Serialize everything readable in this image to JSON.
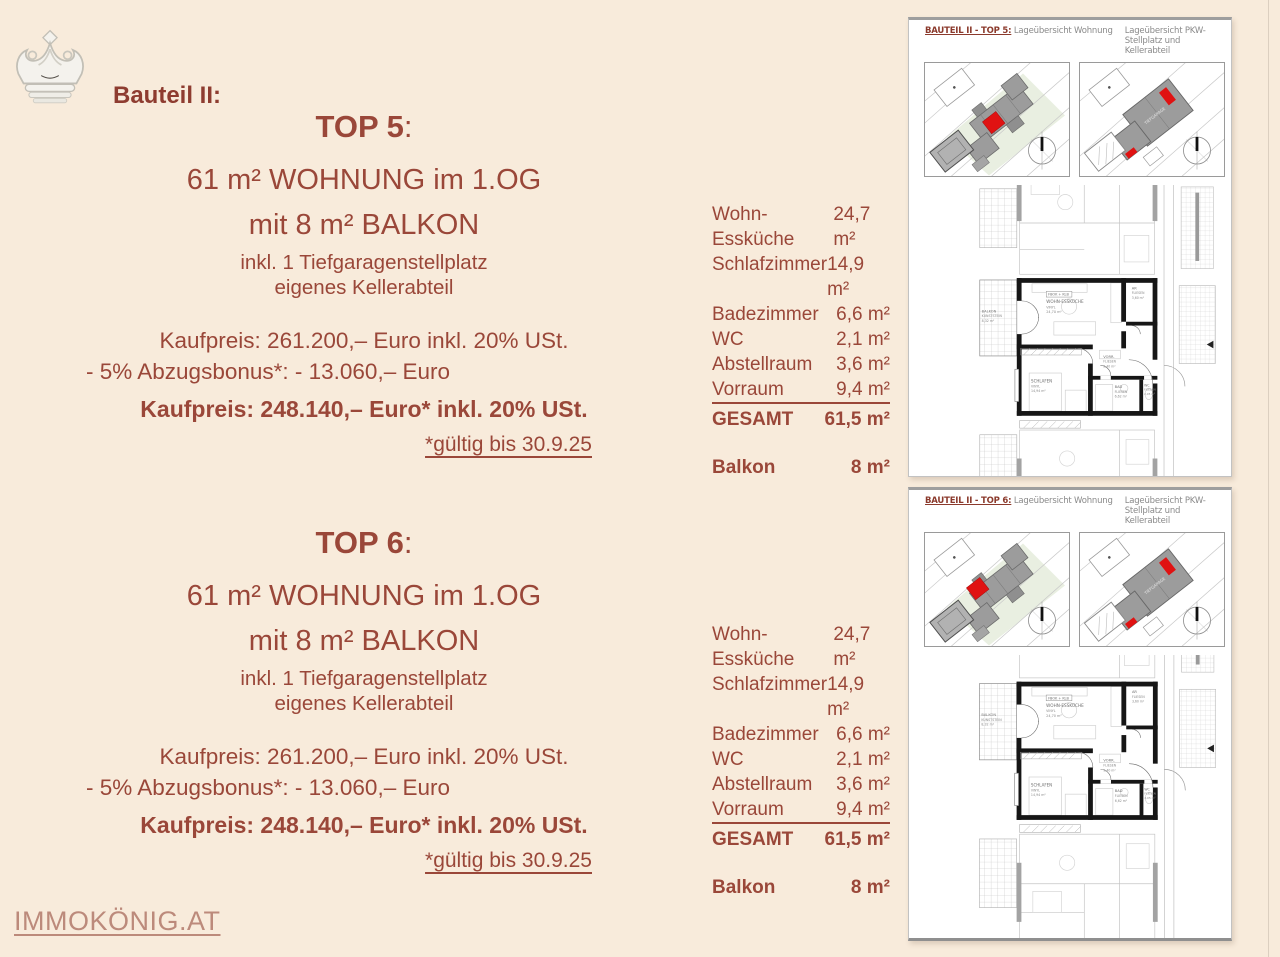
{
  "page": {
    "background": "#f8ebdb",
    "accent": "#9a4739",
    "accent_dark": "#8e3c30",
    "link_color": "#bc8a7b",
    "highlight_red": "#e01212",
    "building_gray": "#9c9c9c"
  },
  "brand": {
    "label": "Bauteil II:",
    "logo_icon": "crown-icon",
    "footer_link": "IMMOKÖNIG.AT"
  },
  "listings": [
    {
      "title": "TOP 5",
      "colon": ":",
      "subtitle1": "61 m² WOHNUNG im 1.OG",
      "subtitle2": "mit 8 m² BALKON",
      "detail1": "inkl. 1 Tiefgaragenstellplatz",
      "detail2": "eigenes Kellerabteil",
      "price_original": "Kaufpreis: 261.200,– Euro inkl. 20% USt.",
      "price_discount": "- 5% Abzugsbonus*: - 13.060,– Euro",
      "price_final": "Kaufpreis: 248.140,– Euro* inkl. 20% USt.",
      "validity": "*gültig bis 30.9.25",
      "rooms": [
        {
          "label": "Wohn-Essküche",
          "area": "24,7 m²"
        },
        {
          "label": "Schlafzimmer",
          "area": "14,9 m²"
        },
        {
          "label": "Badezimmer",
          "area": "6,6 m²"
        },
        {
          "label": "WC",
          "area": "2,1 m²"
        },
        {
          "label": "Abstellraum",
          "area": "3,6 m²"
        },
        {
          "label": "Vorraum",
          "area": "9,4 m²"
        }
      ],
      "total_label": "GESAMT",
      "total_area": "61,5 m²",
      "balcony_label": "Balkon",
      "balcony_area": "8 m²",
      "plan": {
        "header_bold": "BAUTEIL II - TOP 5:",
        "header_left": "Lageübersicht Wohnung",
        "header_right": "Lageübersicht PKW-Stellplatz und Kellerabteil"
      }
    },
    {
      "title": "TOP 6",
      "colon": ":",
      "subtitle1": "61 m² WOHNUNG im 1.OG",
      "subtitle2": "mit 8 m² BALKON",
      "detail1": "inkl. 1 Tiefgaragenstellplatz",
      "detail2": "eigenes Kellerabteil",
      "price_original": "Kaufpreis: 261.200,– Euro inkl. 20% USt.",
      "price_discount": "- 5% Abzugsbonus*: - 13.060,– Euro",
      "price_final": "Kaufpreis: 248.140,– Euro* inkl. 20% USt.",
      "validity": "*gültig bis 30.9.25",
      "rooms": [
        {
          "label": "Wohn-Essküche",
          "area": "24,7 m²"
        },
        {
          "label": "Schlafzimmer",
          "area": "14,9 m²"
        },
        {
          "label": "Badezimmer",
          "area": "6,6 m²"
        },
        {
          "label": "WC",
          "area": "2,1 m²"
        },
        {
          "label": "Abstellraum",
          "area": "3,6 m²"
        },
        {
          "label": "Vorraum",
          "area": "9,4 m²"
        }
      ],
      "total_label": "GESAMT",
      "total_area": "61,5 m²",
      "balcony_label": "Balkon",
      "balcony_area": "8 m²",
      "plan": {
        "header_bold": "BAUTEIL II - TOP 6:",
        "header_left": "Lageübersicht Wohnung",
        "header_right": "Lageübersicht PKW-Stellplatz und Kellerabteil"
      }
    }
  ],
  "floorplan": {
    "tag": "FBOK + KLB",
    "wohn": [
      "WOHN-ESSKÜCHE",
      "VINYL",
      "24,70 m²"
    ],
    "ar": [
      "AR",
      "FLIESEN",
      "3,60 m²"
    ],
    "vorraum": [
      "VORR.",
      "FLIESEN",
      "9,40 m²"
    ],
    "schlafen": [
      "SCHLAFEN",
      "VINYL",
      "14,94 m²"
    ],
    "bad": [
      "BAD",
      "FLIESEN",
      "6,62 m²"
    ],
    "wc": [
      "WC",
      "FLIESEN",
      "2,05 m²"
    ],
    "balkon": [
      "BALKON",
      "KUNSTSTEIN",
      "8,32 m²"
    ]
  }
}
